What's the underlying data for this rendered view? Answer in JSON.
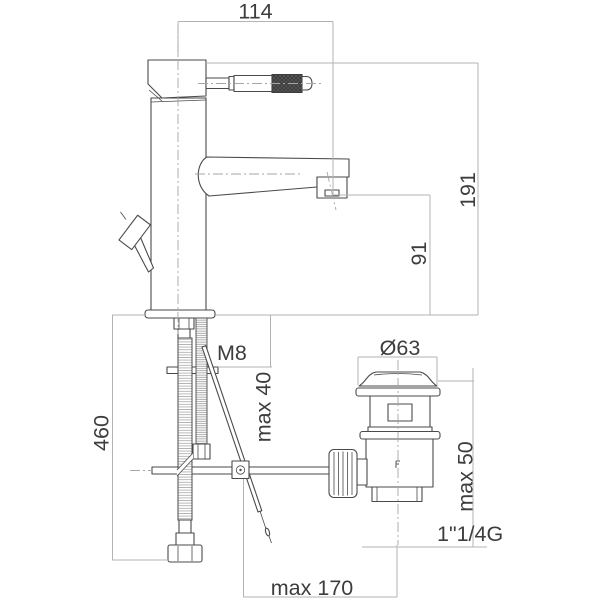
{
  "diagram": {
    "type": "technical-drawing",
    "dimensions": [
      {
        "id": "spout-reach",
        "text": "114"
      },
      {
        "id": "overall-height",
        "text": "191"
      },
      {
        "id": "outlet-height",
        "text": "91"
      },
      {
        "id": "fixing-thread",
        "text": "M8"
      },
      {
        "id": "max-deck-thickness",
        "text": "max 40"
      },
      {
        "id": "hose-length",
        "text": "460"
      },
      {
        "id": "waste-diameter",
        "text": "Ø63"
      },
      {
        "id": "waste-max-deck",
        "text": "max 50"
      },
      {
        "id": "waste-thread",
        "text": "1\"1/4G"
      },
      {
        "id": "max-rod-distance",
        "text": "max 170"
      }
    ],
    "colors": {
      "background": "#ffffff",
      "outline": "#4a4a4a",
      "dimension_line": "#b3b3b3",
      "center_line": "#a6a6a6",
      "text": "#3d3d3d",
      "knurl_dark": "#3c3c3c"
    }
  }
}
